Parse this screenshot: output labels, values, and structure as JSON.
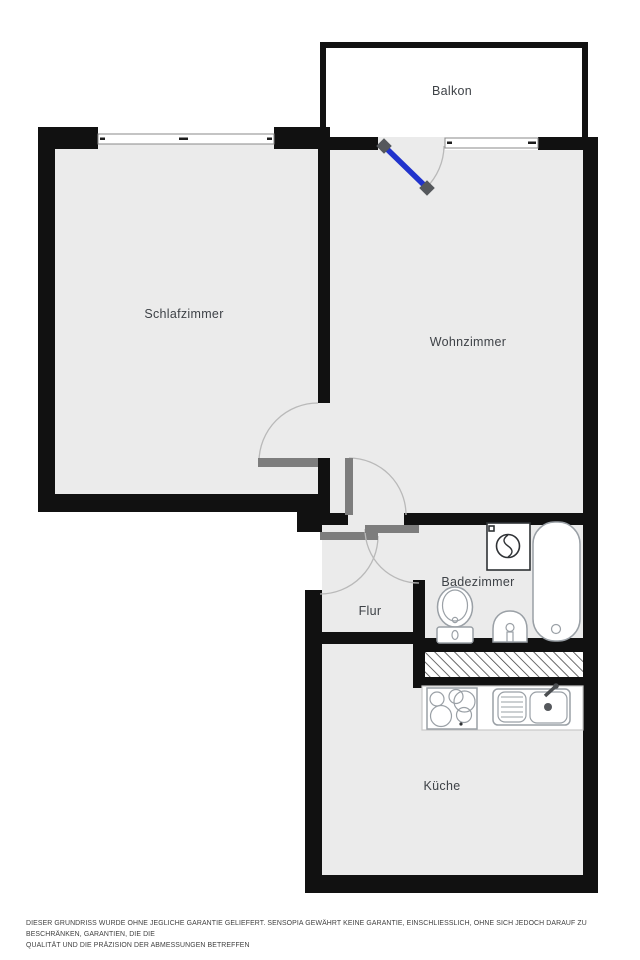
{
  "plan": {
    "rooms": [
      {
        "name": "Balkon"
      },
      {
        "name": "Schlafzimmer"
      },
      {
        "name": "Wohnzimmer"
      },
      {
        "name": "Badezimmer"
      },
      {
        "name": "Flur"
      },
      {
        "name": "Küche"
      }
    ],
    "fixtures": {
      "bathroom": [
        "washing-machine",
        "bathtub",
        "toilet",
        "washbasin"
      ],
      "kitchen": [
        "stove-4-burners",
        "kitchen-sink-with-drainboard",
        "faucet"
      ],
      "other": [
        "hatched-shaft",
        "balcony-door-blue",
        "interior-door-x4",
        "window-x2"
      ]
    },
    "disclaimer_line1": "DIESER GRUNDRISS WURDE OHNE JEGLICHE GARANTIE GELIEFERT. SENSOPIA GEWÄHRT KEINE GARANTIE, EINSCHLIESSLICH, OHNE SICH JEDOCH DARAUF ZU BESCHRÄNKEN, GARANTIEN, DIE DIE",
    "disclaimer_line2": "QUALITÄT UND DIE PRÄZISION DER ABMESSUNGEN BETREFFEN"
  },
  "colors": {
    "wall": "#111111",
    "floor": "#ebebeb",
    "door_leaf": "#7d7d7d",
    "swing_arc": "#b9b9b9",
    "balcony_door": "#2133cc",
    "hinge": "#55585c",
    "fixture_outline": "#9aa0a6",
    "fixture_dark": "#2f3235",
    "window_line": "#8a8a8a",
    "label_text": "#3e4247",
    "disclaimer_text": "#3f3f3f",
    "background": "#ffffff"
  }
}
